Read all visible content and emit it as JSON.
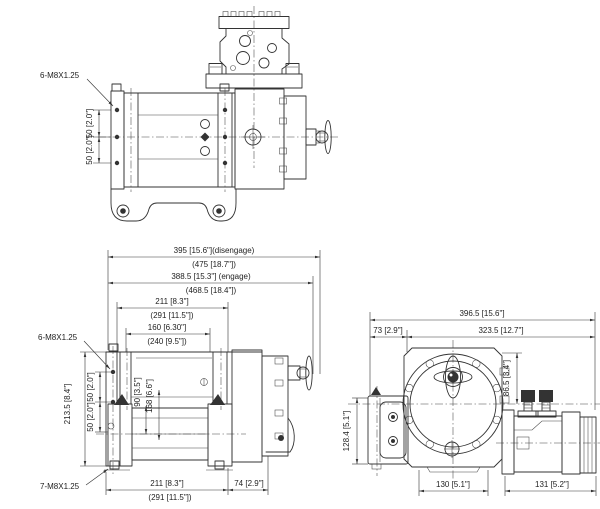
{
  "drawing": {
    "top_view": {
      "bolt_callout": "6-M8X1.25",
      "hole_pitch_dims": [
        "50 [2.0\"]",
        "50 [2.0\"]"
      ]
    },
    "length_dims": {
      "overall_disengage": "395 [15.6\"](disengage)",
      "overall_disengage_alt": "(475 [18.7\"])",
      "overall_engage": "388.5 [15.3\"] (engage)",
      "overall_engage_alt": "(468.5 [18.4\"])",
      "flange_width": "211 [8.3\"]",
      "flange_width_alt": "(291 [11.5\"])",
      "drum_width": "160 [6.30\"]",
      "drum_width_alt": "(240 [9.5\"])"
    },
    "front_view": {
      "bolt_callout_side": "6-M8X1.25",
      "bolt_callout_feet": "7-M8X1.25",
      "height_dim": "213.5 [8.4\"]",
      "hole_pitch_dims": [
        "50 [2.0\"]",
        "50 [2.0\"]"
      ],
      "drum_dims": [
        "90 [3.5\"]",
        "168 [6.6\"]"
      ],
      "base_length_dim": "211 [8.3\"]",
      "base_length_alt": "(291 [11.5\"])",
      "gear_housing_dim": "74 [2.9\"]"
    },
    "side_view": {
      "overall_width": "396.5 [15.6\"]",
      "bracket_width": "73 [2.9\"]",
      "body_width": "323.5 [12.7\"]",
      "port_height": "86.5 [3.4\"]",
      "bracket_height": "128.4 [5.1\"]",
      "base_width": "130 [5.1\"]",
      "motor_length": "131 [5.2\"]"
    }
  }
}
